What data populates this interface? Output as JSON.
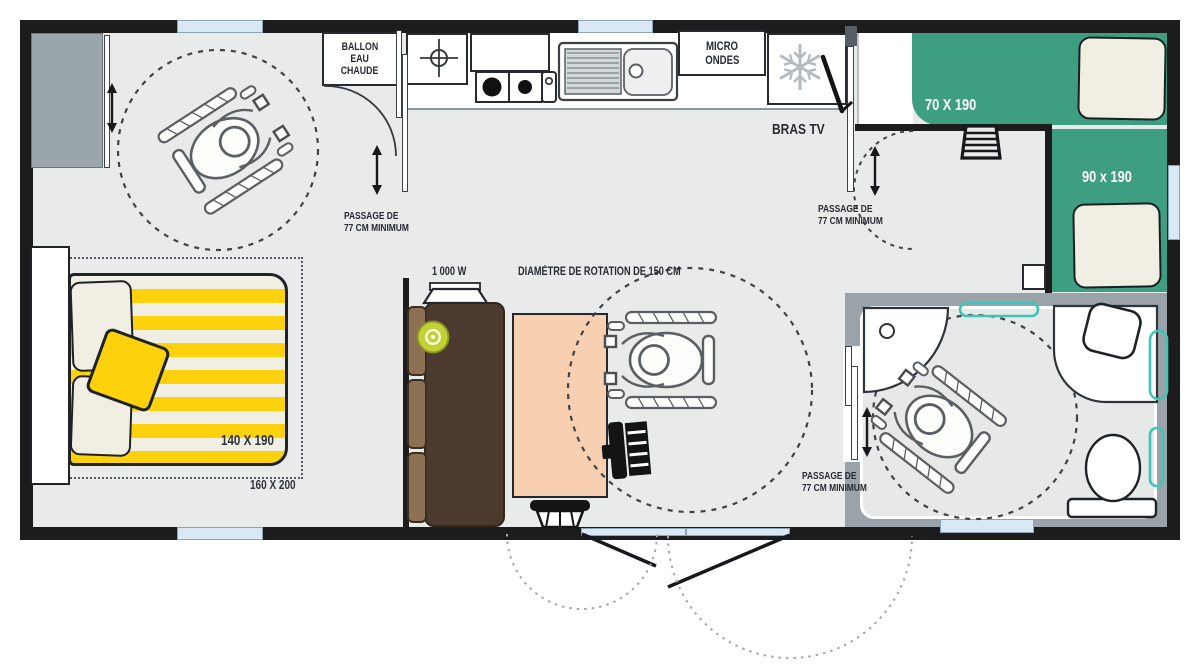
{
  "labels": {
    "water_heater": [
      "BALLON",
      "EAU",
      "CHAUDE"
    ],
    "microwave": [
      "MICRO",
      "ONDES"
    ],
    "tv_arm": "BRAS TV",
    "heater_power": "1 000 W",
    "rotation_diameter": "DIAMÈTRE DE ROTATION DE 150 CM",
    "passage": {
      "line1": "PASSAGE DE",
      "line2": "77 CM MINIMUM"
    },
    "beds": {
      "bunk_top": "70 X 190",
      "single_right": "90 x 190",
      "double": "140 X 190",
      "double_footprint": "160 X 200"
    }
  },
  "icons": {
    "fridge": "snowflake-icon",
    "hob": "two-burner-hob-icon",
    "sink": "kitchen-sink-icon",
    "gas_point": "crosshair-circle-icon",
    "wheelchair": "wheelchair-user-icon",
    "toilet": "toilet-icon",
    "shower": "corner-shower-icon",
    "washbasin": "washbasin-icon",
    "ladder": "bunk-ladder-icon",
    "double_arrow": "double-arrow-icon",
    "door_swing": "door-swing-arc-icon",
    "rotation_circle": "dashed-rotation-circle-icon"
  },
  "colors": {
    "wall": "#1c1c1c",
    "floor": "#e9ebea",
    "bed_green": "#3d9e81",
    "mattress_cream": "#f1efe4",
    "bed_yellow": "#fdd20c",
    "table_peach": "#f8cfb1",
    "sofa_dark": "#4b3a2d",
    "sofa_cushion": "#8c7154",
    "cushion_lime": "#c2d233",
    "window_blue": "#d8e8f5",
    "bathroom_wall_gray": "#9aa3aa",
    "wardrobe_gray": "#9ba5ac",
    "accent_teal": "#3fc4ba"
  }
}
